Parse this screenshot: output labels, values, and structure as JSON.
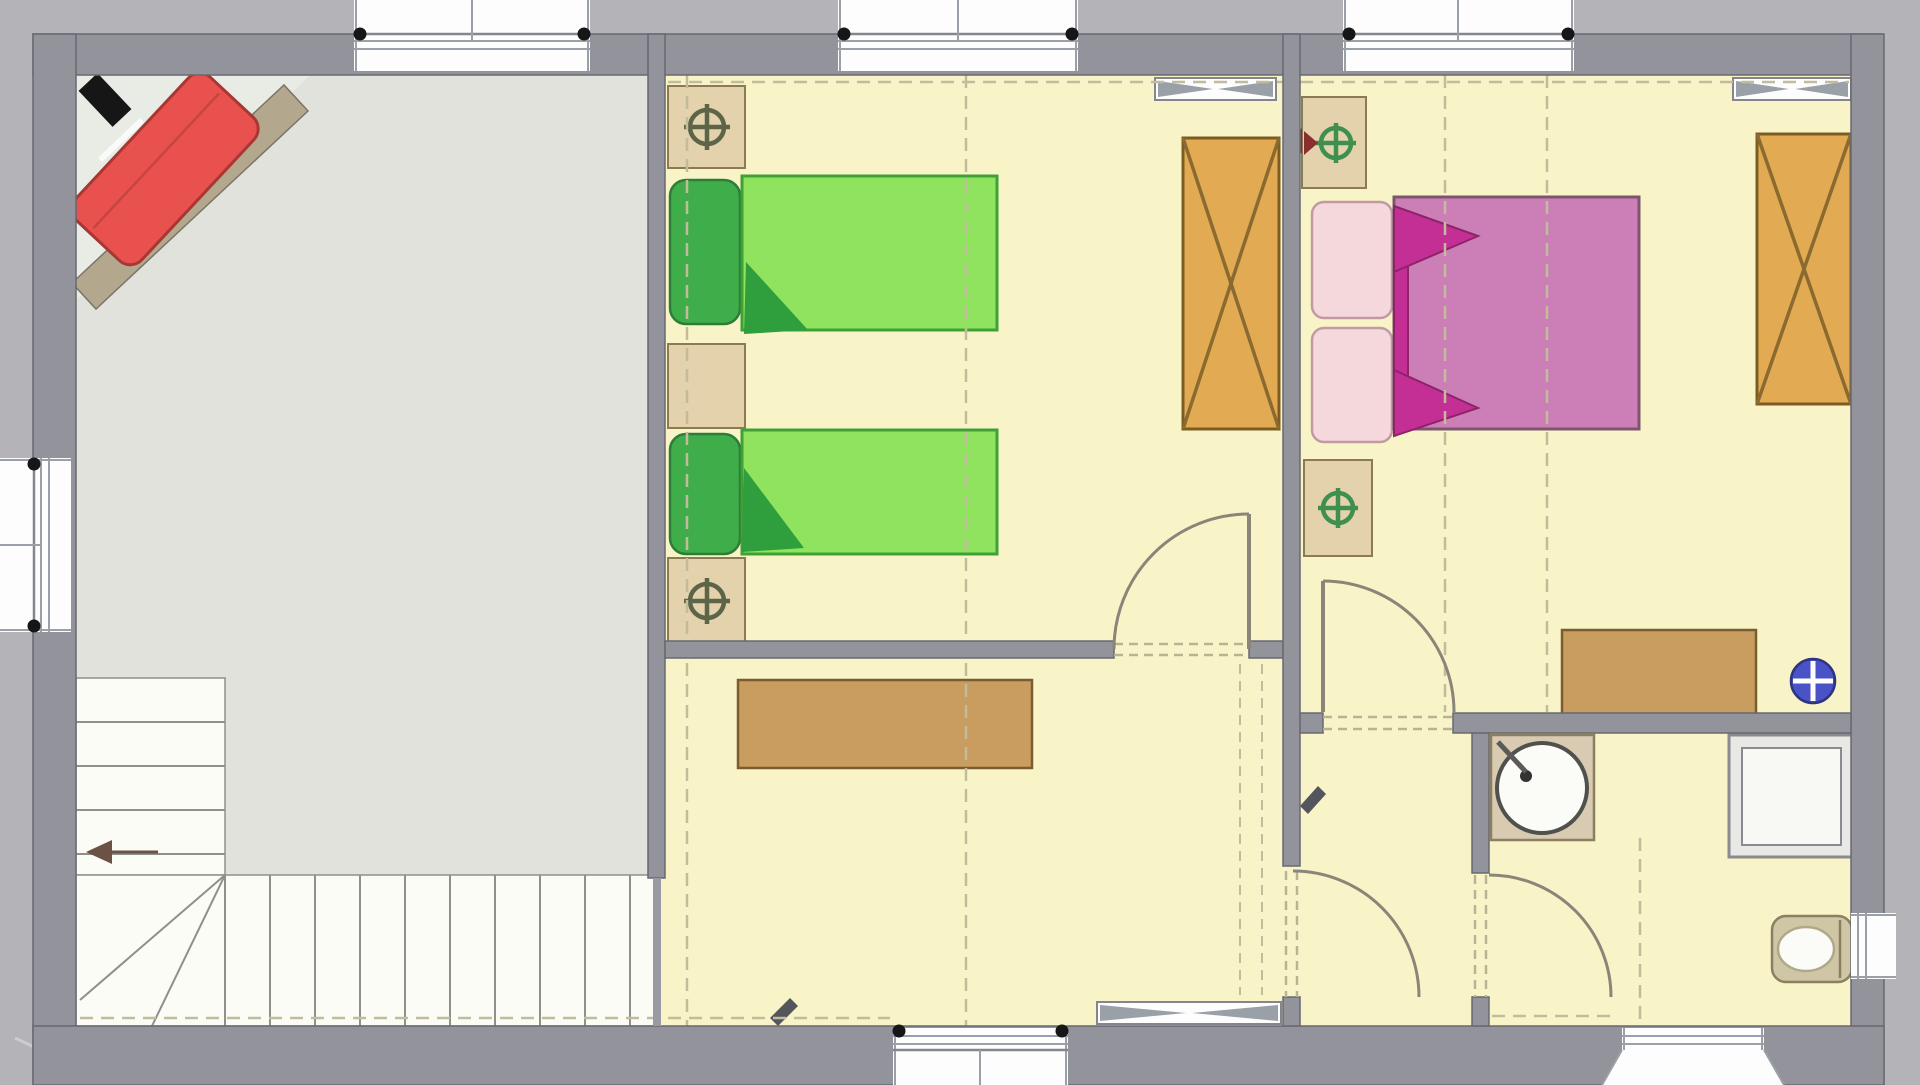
{
  "canvas": {
    "width": 1920,
    "height": 1085
  },
  "colors": {
    "exterior": "#b4b4b8",
    "wall": "#93939b",
    "wall-line": "#686872",
    "rail": "#9a9aa2",
    "floor-room": "#f8f4c8",
    "floor-landing": "#e2e2dc",
    "floor-niche": "#e9ece5",
    "floor-stairs": "#fcfcf6",
    "band": "#b3a78d",
    "band-line": "#7b7567",
    "window": "#fdfdfe",
    "window-frame": "#9aa0a8",
    "window-face": "#85858d",
    "dash": "#c2bb9c",
    "threshold": "#b9b293",
    "door-arc": "#8a8578",
    "tread": "#90908a",
    "tan": "#e3d2ac",
    "tan-line": "#8b7b52",
    "wardrobe": "#e2aa52",
    "wardrobe-line": "#8a6a2e",
    "wardrobe-edge": "#7c5c22",
    "bed-green": "#8fe35e",
    "bed-green-line": "#3fa036",
    "pillow-green": "#3fae4a",
    "pillow-green-line": "#2e7d36",
    "fold-green": "#2f9e3c",
    "brown": "#c89d5f",
    "brown-line": "#7a5c30",
    "bed-pink": "#cb7fb6",
    "bed-pink-line": "#7d566e",
    "pillow-pink": "#f4d8dc",
    "pillow-pink-line": "#c29aa4",
    "fold-pink": "#c42f96",
    "fold-pink-line": "#8e2369",
    "sofa": "#e8514e",
    "sofa-line": "#a83734",
    "lamp-ring": "#5c6548",
    "green-ring": "#3f8f4f",
    "glyph-red": "#8a2f2f",
    "glyph-dark": "#55555e",
    "blue": "#4a52c8",
    "blue-line": "#2e3580",
    "fixture": "#8a8a90",
    "counter": "#d9cbb2",
    "counter-line": "#8a8060",
    "seat": "#cfc6a5",
    "bowl": "#fbfbf8",
    "black": "#161616"
  },
  "plan": {
    "type": "floor-plan-upper-storey",
    "rooms": [
      {
        "id": "landing",
        "floor": "gray",
        "features": [
          "corner-sofa-niche",
          "diagonal-knee-wall",
          "north-mark",
          "l-shaped-stair"
        ]
      },
      {
        "id": "bedroom-left",
        "floor": "yellow",
        "features": [
          "two-single-beds",
          "three-nightstands",
          "wardrobe",
          "skylight"
        ]
      },
      {
        "id": "bedroom-right",
        "floor": "yellow",
        "features": [
          "double-bed",
          "two-nightstands",
          "wardrobe",
          "desk",
          "skylight",
          "blue-ceiling-symbol"
        ]
      },
      {
        "id": "hallway",
        "floor": "yellow",
        "features": [
          "sideboard",
          "skylight"
        ]
      },
      {
        "id": "corridor",
        "floor": "yellow",
        "features": []
      },
      {
        "id": "bathroom",
        "floor": "yellow",
        "features": [
          "washbasin",
          "shower",
          "toilet",
          "side-window"
        ]
      }
    ],
    "furniture_counts": {
      "single_beds": 2,
      "double_beds": 1,
      "nightstands": 5,
      "wardrobes": 2,
      "sofa": 1,
      "sideboard": 1,
      "desk": 1
    },
    "openings": {
      "door_arcs": 4,
      "top_window_bays": 3,
      "bottom_window_bays": 2,
      "left_windows": 1,
      "right_windows": 1,
      "skylights": 3
    },
    "stairs": {
      "upper_flight_treads": 5,
      "lower_flight_treads": 10,
      "winder_lines": 2,
      "direction_arrow": "left"
    }
  }
}
